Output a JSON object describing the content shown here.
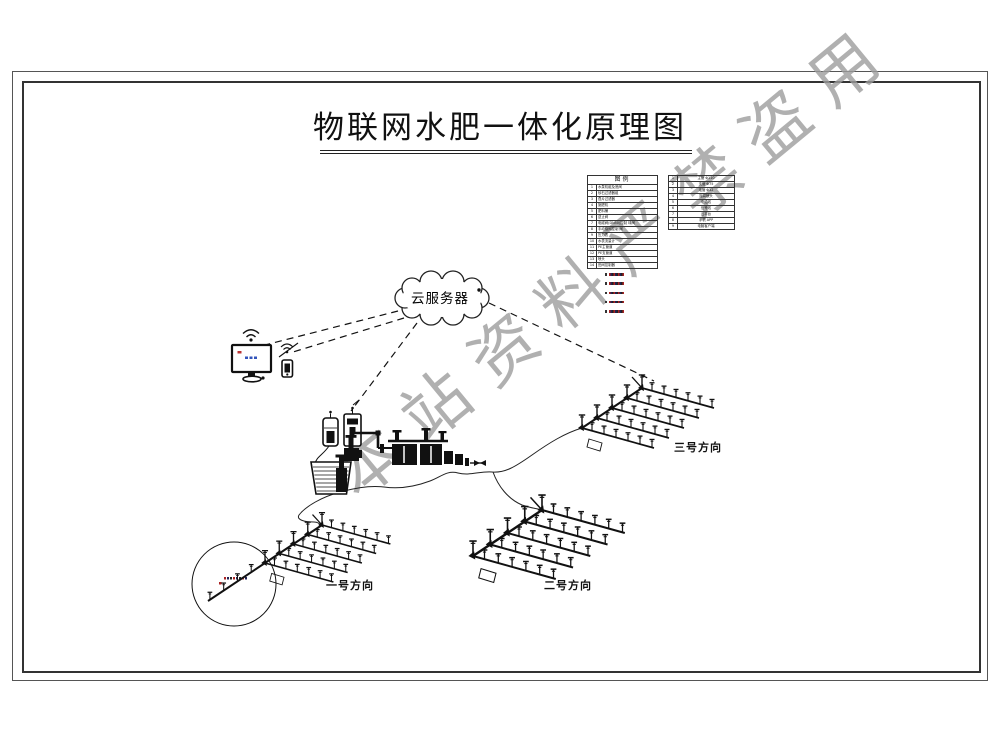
{
  "title": "物联网水肥一体化原理图",
  "watermark": "本站资料严禁盗用",
  "cloud": {
    "label": "云服务器"
  },
  "legend": {
    "header": "图例",
    "left_rows": [
      {
        "no": "1",
        "text": "水泵机组及底阀"
      },
      {
        "no": "2",
        "text": "砂石过滤器组"
      },
      {
        "no": "3",
        "text": "叠片过滤器"
      },
      {
        "no": "4",
        "text": "施肥机"
      },
      {
        "no": "5",
        "text": "肥料桶"
      },
      {
        "no": "6",
        "text": "逆止阀"
      },
      {
        "no": "7",
        "text": "电磁阀(DN50)控制 球阀"
      },
      {
        "no": "8",
        "text": "手动蝶阀控制 阀"
      },
      {
        "no": "9",
        "text": "压力表"
      },
      {
        "no": "10",
        "text": "水表流量计"
      },
      {
        "no": "11",
        "text": "PE主管道"
      },
      {
        "no": "12",
        "text": "PE支管道"
      },
      {
        "no": "13",
        "text": "喷头"
      },
      {
        "no": "14",
        "text": "田间控制器"
      }
    ],
    "right_rows": [
      {
        "no": "1",
        "text": "主管 Φ110"
      },
      {
        "no": "2",
        "text": "支管 Φ75"
      },
      {
        "no": "3",
        "text": "毛管 Φ32"
      },
      {
        "no": "4",
        "text": "摇臂喷头"
      },
      {
        "no": "5",
        "text": "电缆线"
      },
      {
        "no": "6",
        "text": "信号线"
      },
      {
        "no": "7",
        "text": "云平台"
      },
      {
        "no": "8",
        "text": "手机 APP"
      },
      {
        "no": "9",
        "text": "电脑客户端"
      }
    ],
    "notes": [
      "",
      "",
      "",
      "",
      ""
    ]
  },
  "fields": [
    {
      "label": "一号方向"
    },
    {
      "label": "二号方向"
    },
    {
      "label": "三号方向"
    }
  ]
}
